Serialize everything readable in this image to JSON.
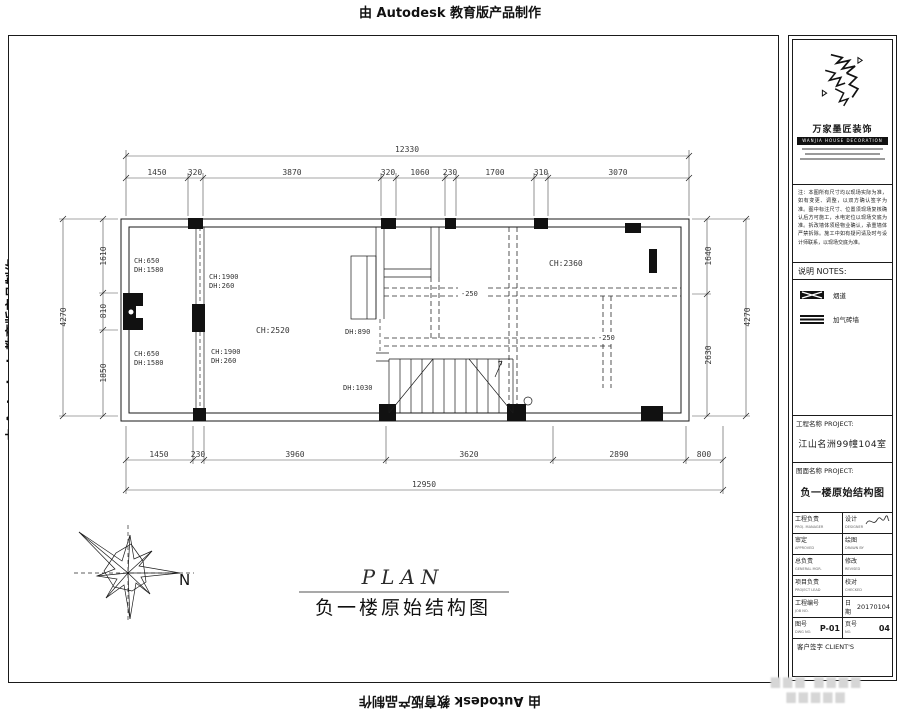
{
  "ink": "#1a1a1a",
  "edu_banner": "由 Autodesk 教育版产品制作",
  "drawing": {
    "caption_en": "PLAN",
    "caption_cn": "负一楼原始结构图",
    "north_label": "N",
    "dims": {
      "top_overall": "12330",
      "top_segments": [
        "1450",
        "320",
        "3870",
        "320",
        "1060",
        "230",
        "1700",
        "310",
        "3070"
      ],
      "bottom_segments": [
        "1450",
        "230",
        "3960",
        "3620",
        "2890",
        "800"
      ],
      "bottom_overall": "12950",
      "left_overall": "4270",
      "left_segments": [
        "1610",
        "810",
        "1850"
      ],
      "right_overall": "4270",
      "right_segments": [
        "1640",
        "2630"
      ]
    },
    "labels": {
      "left_window_top_l1": "CH:650",
      "left_window_top_l2": "DH:1580",
      "left_window_bottom_l1": "CH:650",
      "left_window_bottom_l2": "DH:1580",
      "mid_wall_top_l1": "CH:1900",
      "mid_wall_top_l2": "DH:260",
      "mid_wall_bottom_l1": "CH:1900",
      "mid_wall_bottom_l2": "DH:260",
      "main_room_height": "CH:2520",
      "right_room_height": "CH:2360",
      "door_height_a": "DH:890",
      "door_height_b": "DH:1030",
      "level_mark_a": "-250",
      "level_mark_b": "-250"
    }
  },
  "titleblock": {
    "company_name": "万家墨匠装饰",
    "company_banner": "WANJIA HOUSE DECORATION",
    "notes_paragraph": "注：本图所有尺寸均以现场实际为准，如有变更、调整，以双方确认签字为准。图中标注尺寸、位置须现场复核确认后方可施工，水电定位以现场交底为准。拆改墙体须经物业确认，承重墙体严禁拆除。施工中如有疑问请及时与设计师联系，以现场交底为准。",
    "notes_header": "说明  NOTES:",
    "legend": [
      {
        "label": "烟道"
      },
      {
        "label": "加气砖墙"
      }
    ],
    "project_section": {
      "label": "工程名称 PROJECT:",
      "value": "江山名洲99幢104室"
    },
    "sheet_section": {
      "label": "图面名称 PROJECT:",
      "value": "负一楼原始结构图"
    },
    "fields": {
      "r1l_cn": "工程负责",
      "r1l_en": "PROJ. MANAGER",
      "r1r_cn": "设计",
      "r1r_en": "DESIGNER",
      "r2l_cn": "审定",
      "r2l_en": "APPROVED",
      "r2r_cn": "绘图",
      "r2r_en": "DRAWN BY",
      "r3l_cn": "总负责",
      "r3l_en": "GENERAL MGR.",
      "r3r_cn": "修改",
      "r3r_en": "REVISED",
      "r4l_cn": "项目负责",
      "r4l_en": "PROJECT LEAD",
      "r4r_cn": "校对",
      "r4r_en": "CHECKED",
      "r5l_cn": "工程编号",
      "r5l_en": "JOB NO.",
      "r5r_cn": "日期",
      "r5r_en": "DATE",
      "date_value": "20170104",
      "r6l_cn": "图号",
      "r6l_en": "DWG NO.",
      "dwg_no": "P-01",
      "r6r_cn": "页号",
      "r6r_en": "NO.",
      "page_no": "04",
      "client_row": "客户签字 CLIENT'S"
    }
  },
  "watermark": {
    "line1": "▆▆▆ ▆▆▆▆",
    "line2": "▆▆▆▆▆"
  }
}
